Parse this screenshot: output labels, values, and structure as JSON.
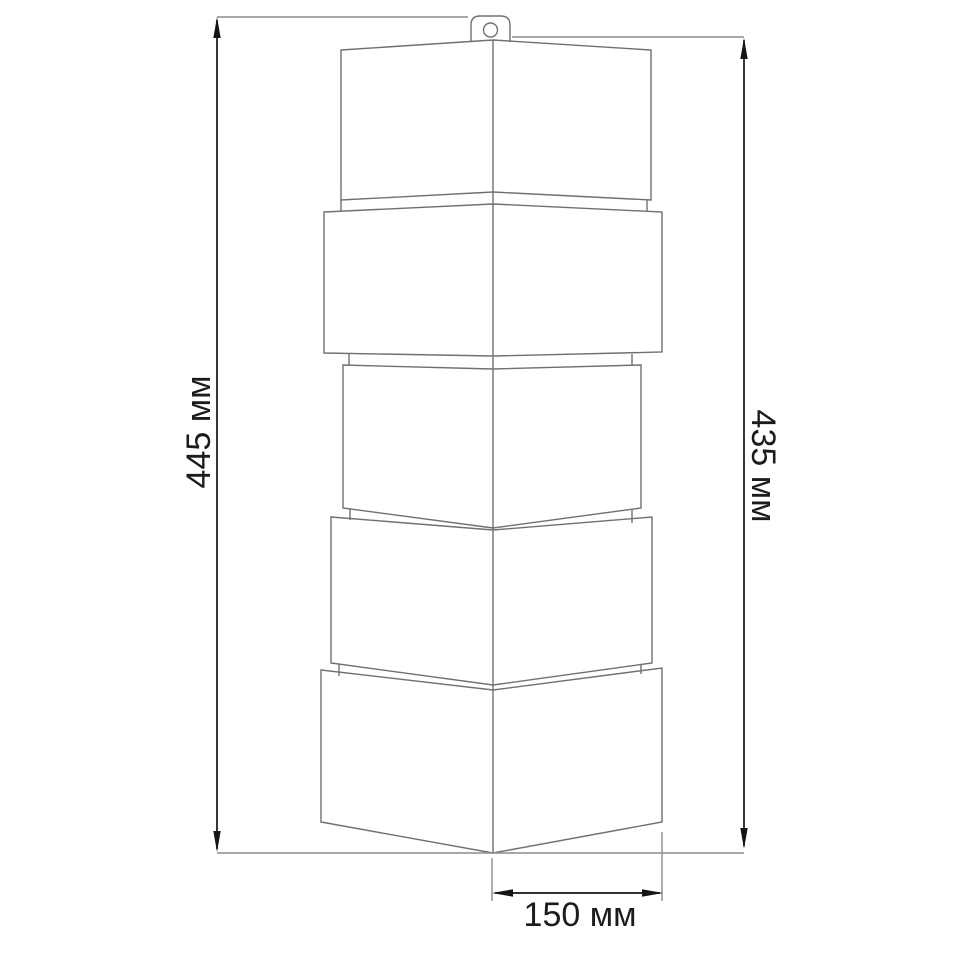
{
  "drawing": {
    "labels": {
      "height_total": "445 мм",
      "height_panel": "435 мм",
      "width_face": "150 мм"
    },
    "colors": {
      "background": "#ffffff",
      "object_line": "#707070",
      "extension_line": "#8c8c8c",
      "dimension_line": "#151515",
      "label_text": "#1c1c1c"
    }
  }
}
